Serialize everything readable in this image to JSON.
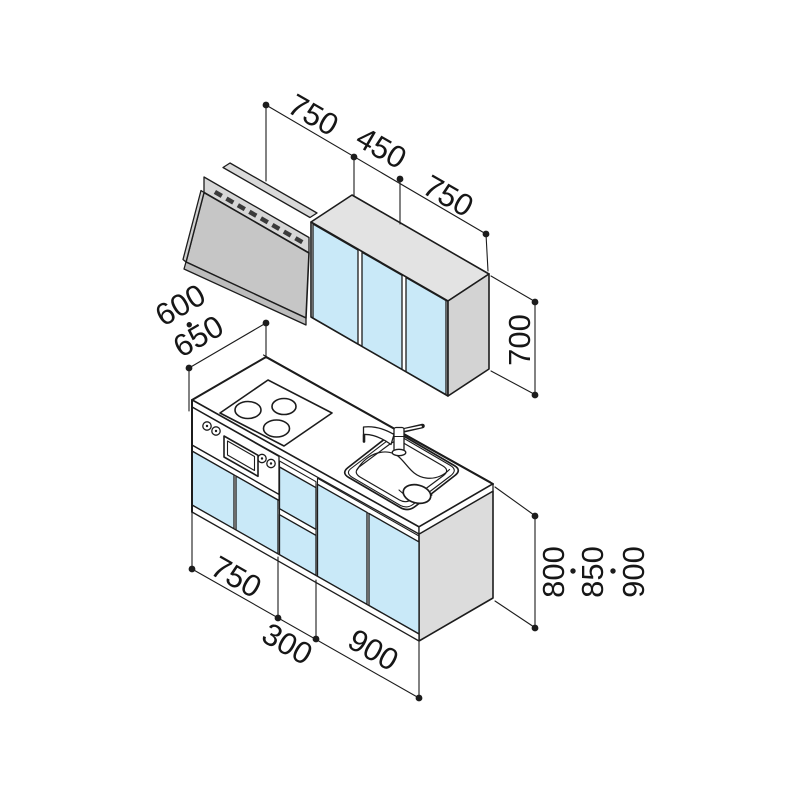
{
  "dimensions": {
    "wall_top_widths": [
      "750",
      "450",
      "750"
    ],
    "wall_cabinet_height": "700",
    "counter_depth_options": [
      "600",
      "650"
    ],
    "counter_height_options": [
      "800",
      "850",
      "900"
    ],
    "base_section_widths": [
      "750",
      "300",
      "900"
    ]
  },
  "colors": {
    "line": "#1c1c1c",
    "door_blue": "#c9e9f8",
    "hood_canopy": "#c6c6c6",
    "hood_band": "#d7d7d7",
    "hood_ridge": "#dadada",
    "hood_rim": "#bdbdbd",
    "hood_cap": "#cfcfcf",
    "hood_slot": "#3a3a3a",
    "cabinet_top_face": "#e3e3e3",
    "cabinet_side_face": "#d3d3d3",
    "end_panel": "#dcdcdc",
    "handle_strip": "#f2f2f2",
    "white": "#ffffff"
  }
}
